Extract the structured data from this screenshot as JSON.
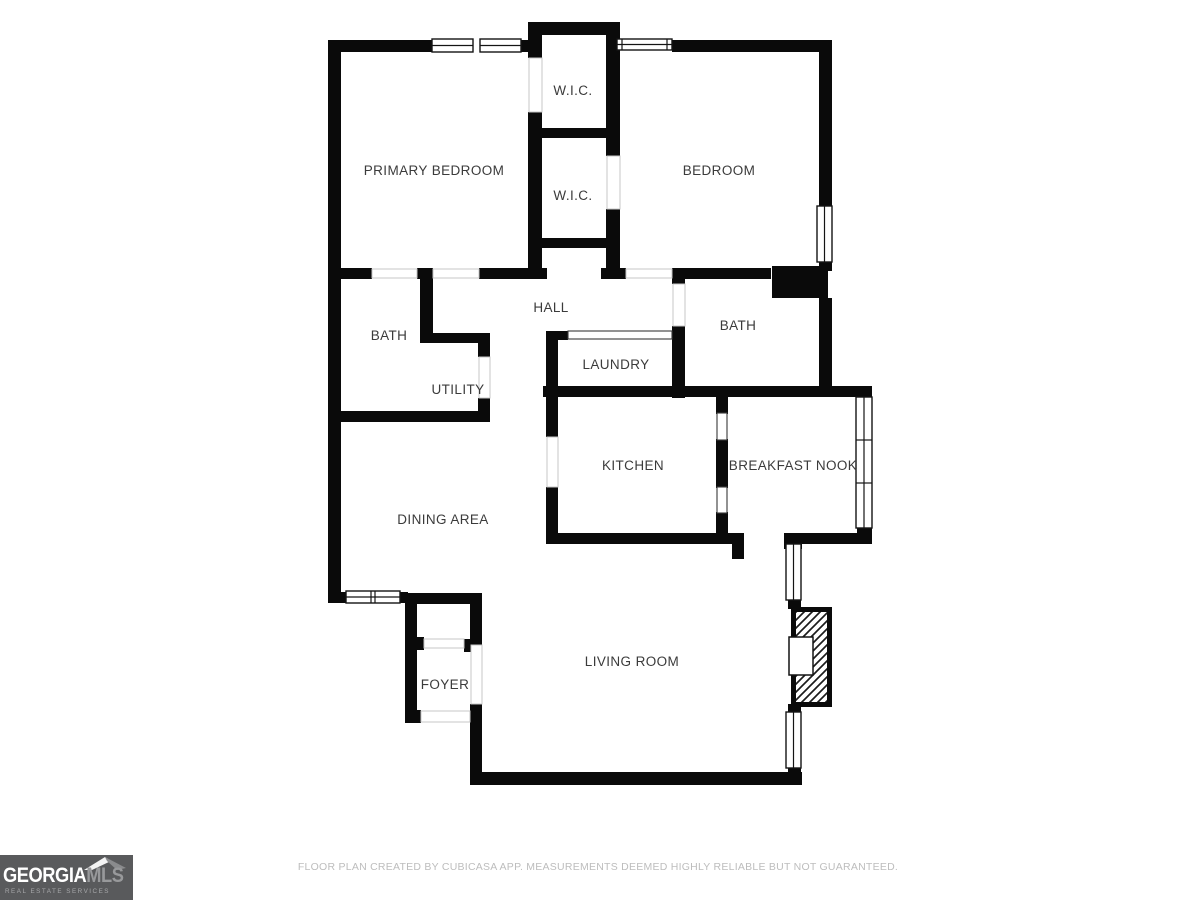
{
  "floor_plan": {
    "wall_color": "#0a0a0a",
    "label_color": "#3b3b3b",
    "rooms": [
      {
        "id": "wic-1",
        "label": "W.I.C."
      },
      {
        "id": "primary-bedroom",
        "label": "PRIMARY BEDROOM"
      },
      {
        "id": "wic-2",
        "label": "W.I.C."
      },
      {
        "id": "bedroom",
        "label": "BEDROOM"
      },
      {
        "id": "bath-left",
        "label": "BATH"
      },
      {
        "id": "hall",
        "label": "HALL"
      },
      {
        "id": "bath-right",
        "label": "BATH"
      },
      {
        "id": "utility",
        "label": "UTILITY"
      },
      {
        "id": "laundry",
        "label": "LAUNDRY"
      },
      {
        "id": "kitchen",
        "label": "KITCHEN"
      },
      {
        "id": "breakfast-nook",
        "label": "BREAKFAST NOOK"
      },
      {
        "id": "dining-area",
        "label": "DINING AREA"
      },
      {
        "id": "foyer",
        "label": "FOYER"
      },
      {
        "id": "living-room",
        "label": "LIVING ROOM"
      }
    ]
  },
  "footer": {
    "disclaimer": "FLOOR PLAN CREATED BY CUBICASA APP. MEASUREMENTS DEEMED HIGHLY RELIABLE BUT NOT GUARANTEED."
  },
  "logo": {
    "brand_primary": "GEORGIA",
    "brand_secondary": "MLS",
    "tagline": "REAL ESTATE SERVICES",
    "background_color": "#595a5c",
    "primary_text_color": "#ffffff",
    "secondary_text_color": "#98999b"
  }
}
